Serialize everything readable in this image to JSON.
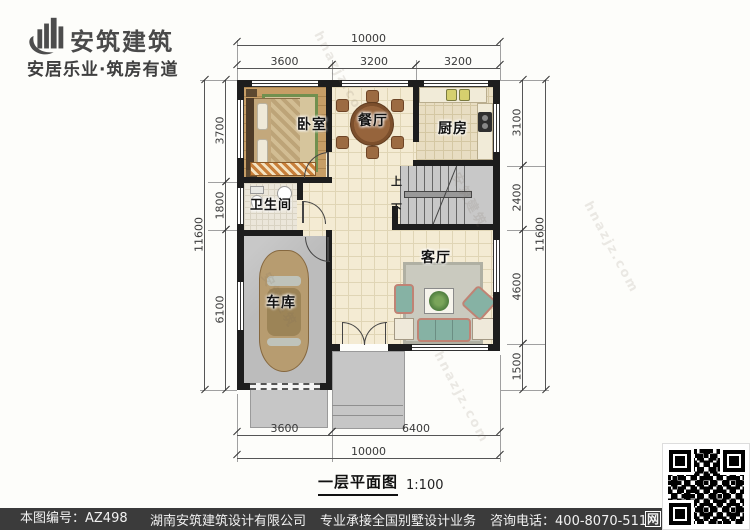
{
  "brand": {
    "name": "安筑建筑",
    "slogan": "安居乐业·筑房有道"
  },
  "rooms": {
    "bedroom": "卧室",
    "dining": "餐厅",
    "kitchen": "厨房",
    "bathroom": "卫生间",
    "garage": "车库",
    "living": "客厅"
  },
  "stairs": {
    "up": "上",
    "down": "下"
  },
  "dims": {
    "top_overall": "10000",
    "top_segments": [
      "3600",
      "3200",
      "3200"
    ],
    "bottom_segments": [
      "3600",
      "6400"
    ],
    "bottom_overall": "10000",
    "left_segments": [
      "3700",
      "1800",
      "6100"
    ],
    "left_overall": "11600",
    "right_segments": [
      "3100",
      "2400",
      "4600",
      "1500"
    ],
    "right_overall": "11600"
  },
  "caption": {
    "title": "一层平面图",
    "scale": "1:100"
  },
  "footer": {
    "drawing_no": "本图编号：AZ498",
    "company": "湖南安筑建筑设计有限公司",
    "service": "专业承接全国别墅设计业务",
    "phone": "咨询电话：400-8070-511",
    "net_label": "网"
  },
  "watermark": {
    "brand": "安筑建筑",
    "site": "hnazjz.com"
  },
  "colors": {
    "footer_bar": "#3b3b3b",
    "wall": "#1d1d1d",
    "tile_floor": "#f4ebd3",
    "wood_floor": "#c79e66",
    "garage_floor": "#bcbcbc",
    "porch": "#c6c6c6",
    "brand_text": "#4a4a4a"
  }
}
